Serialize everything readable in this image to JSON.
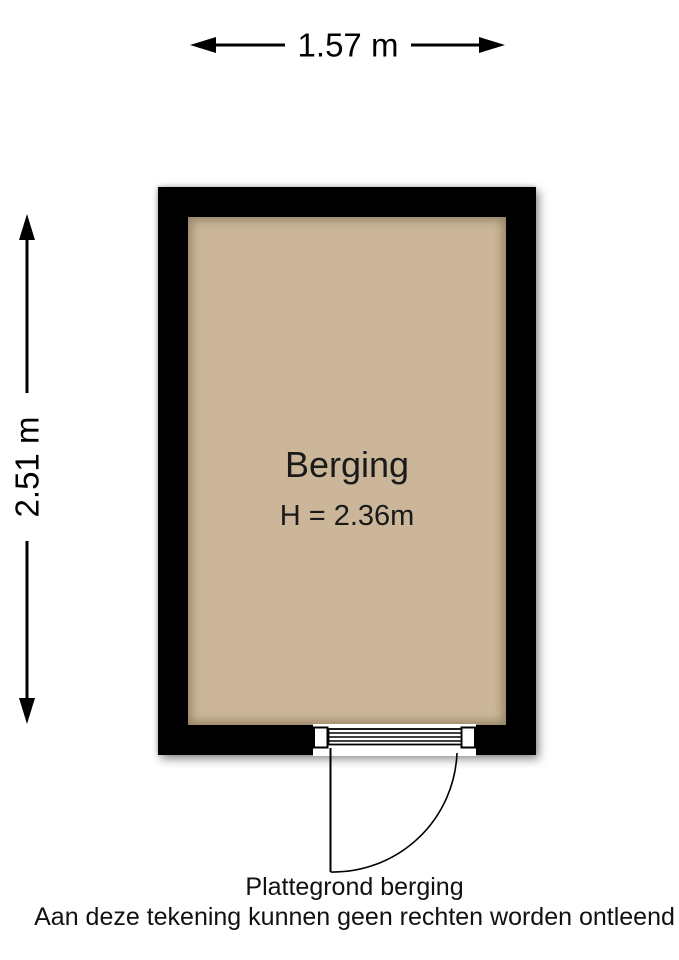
{
  "dimensions": {
    "width_label": "1.57 m",
    "height_label": "2.51 m"
  },
  "room": {
    "name": "Berging",
    "ceiling_height": "H = 2.36m"
  },
  "captions": {
    "title": "Plattegrond berging",
    "disclaimer": "Aan deze tekening kunnen geen rechten worden ontleend"
  },
  "colors": {
    "wall": "#000000",
    "floor": "#cbb699",
    "ink": "#111111"
  }
}
